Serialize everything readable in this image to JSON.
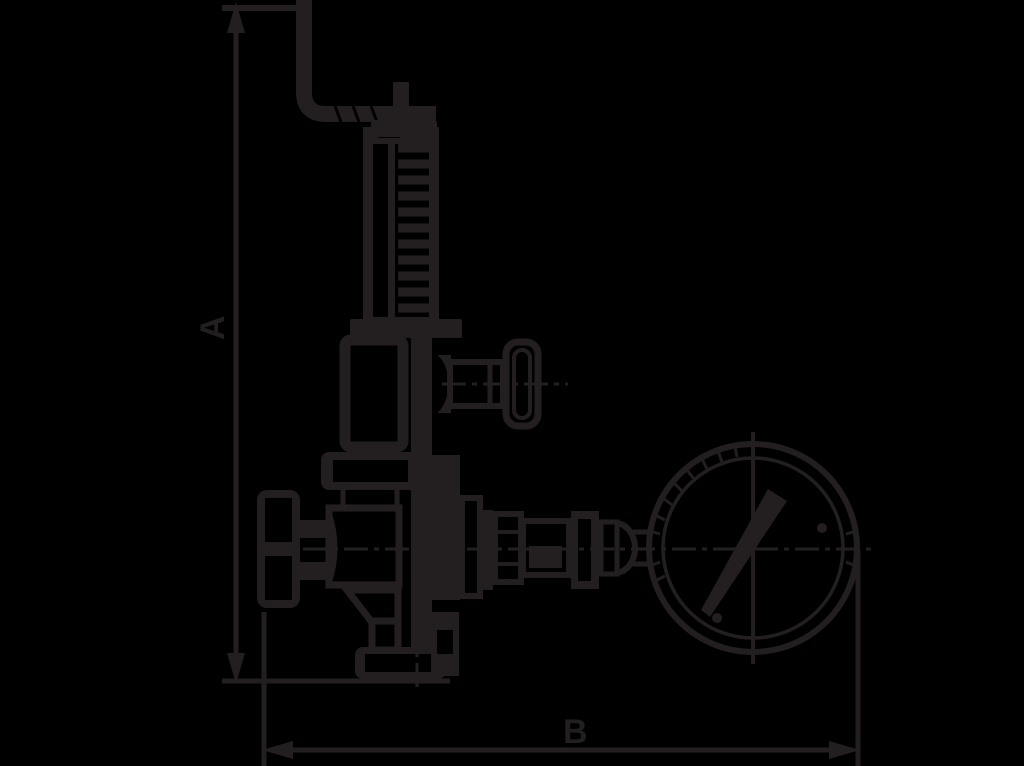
{
  "title": "Safety valve dimensional drawing",
  "colors": {
    "background": "#000000",
    "ink": "#231f20"
  },
  "drawing": {
    "subject": "spring-loaded safety valve with top lever, side test knob, inlet handwheel, bottom flange and pressure gauge",
    "dimension_a_label": "A",
    "dimension_b_label": "B"
  }
}
